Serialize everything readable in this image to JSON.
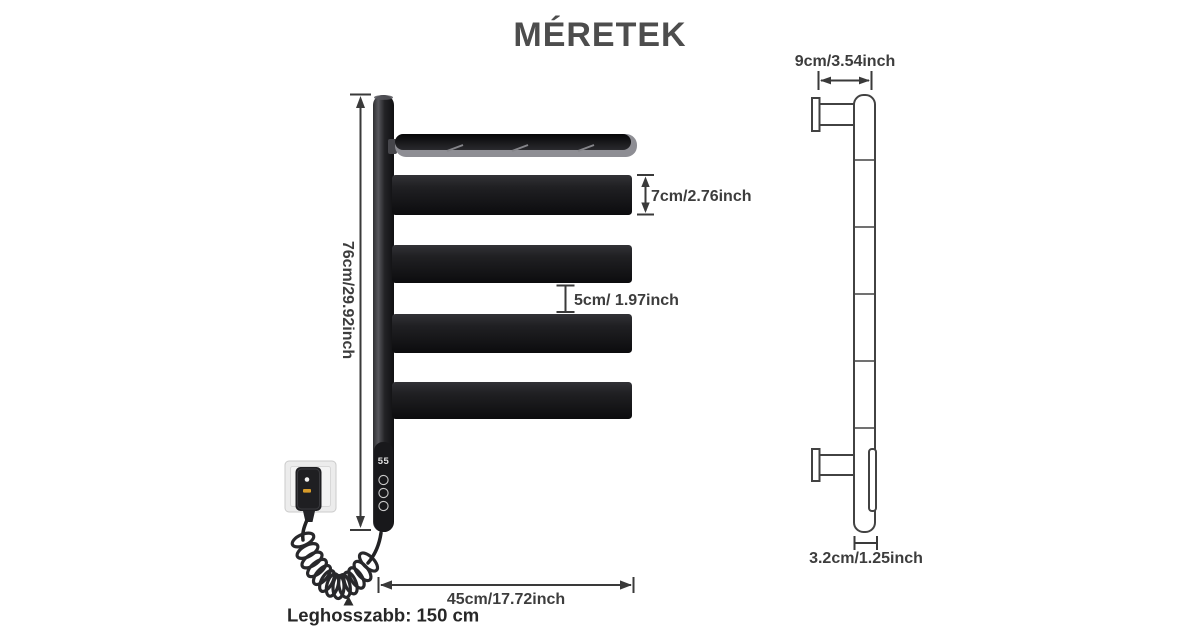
{
  "title": "MÉRETEK",
  "front_view": {
    "display_readout": "55",
    "bar_count": 4,
    "dimensions": {
      "overall_height": "76cm/29.92inch",
      "bar_height": "7cm/2.76inch",
      "bar_gap": "5cm/ 1.97inch",
      "overall_width": "45cm/17.72inch",
      "max_cable_length": "Leghosszabb: 150 cm"
    }
  },
  "side_view": {
    "dimensions": {
      "depth": "9cm/3.54inch",
      "bar_thickness": "3.2cm/1.25inch"
    }
  },
  "colors": {
    "background": "#ffffff",
    "title_text": "#4d4d4d",
    "dimension_text": "#3d3d3d",
    "dimension_lines": "#3a3a3a",
    "bar_fill": "#1d1d20",
    "side_outline": "#424242",
    "led_indicator": "#f2f2f2",
    "amber_indicator": "#d79b2a"
  }
}
